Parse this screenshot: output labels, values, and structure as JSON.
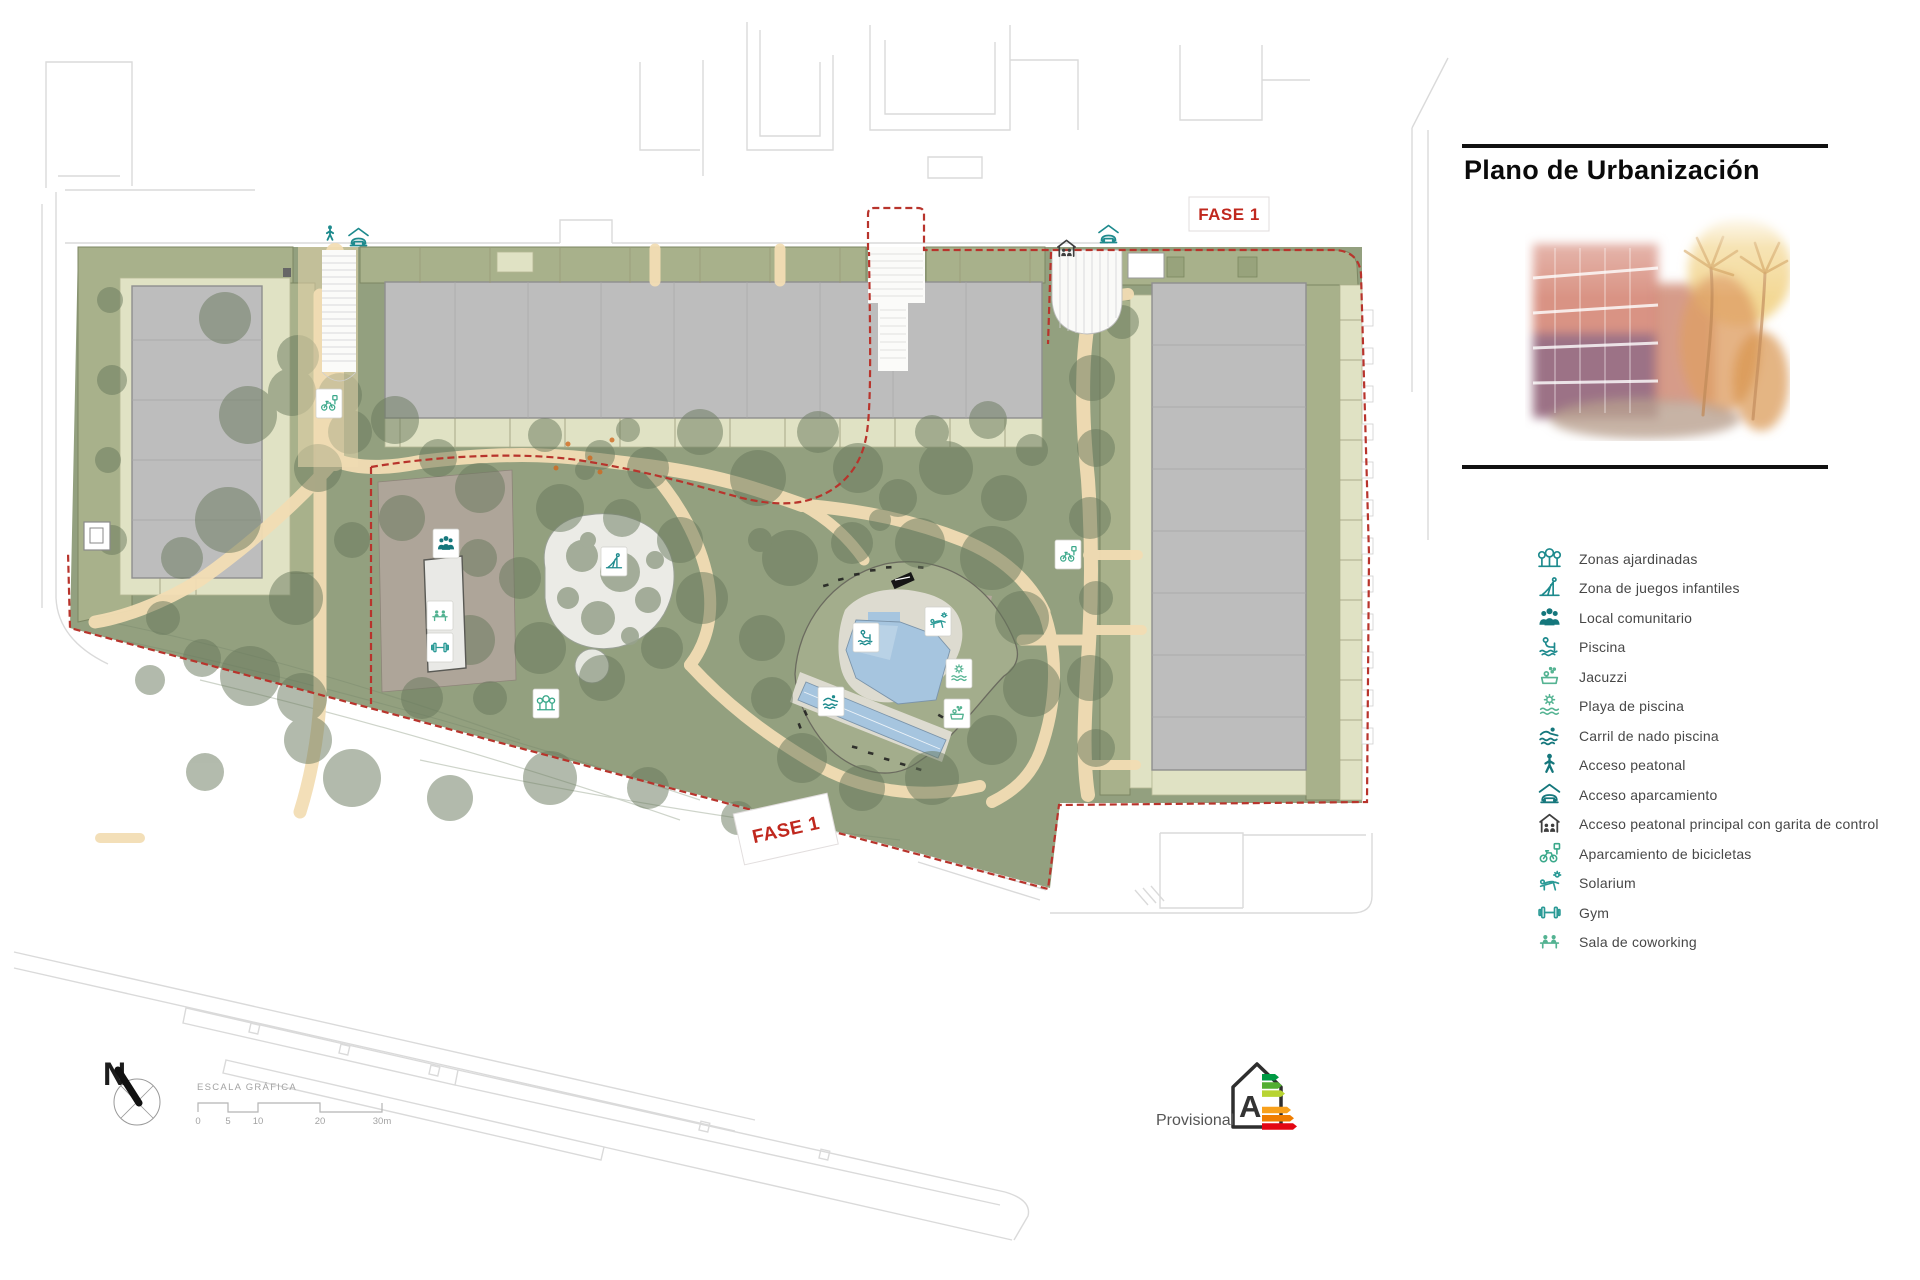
{
  "title": "Plano de Urbanización",
  "map": {
    "fase1_top": "FASE 1",
    "fase1_bottom": "FASE 1"
  },
  "legend": {
    "items": [
      {
        "icon": "trees-icon",
        "label": "Zonas ajardinadas"
      },
      {
        "icon": "playground-icon",
        "label": "Zona de juegos infantiles"
      },
      {
        "icon": "community-icon",
        "label": "Local comunitario"
      },
      {
        "icon": "pool-icon",
        "label": "Piscina"
      },
      {
        "icon": "jacuzzi-icon",
        "label": "Jacuzzi"
      },
      {
        "icon": "pool-beach-icon",
        "label": "Playa de piscina"
      },
      {
        "icon": "swim-lane-icon",
        "label": "Carril de nado piscina"
      },
      {
        "icon": "pedestrian-icon",
        "label": "Acceso peatonal"
      },
      {
        "icon": "parking-access-icon",
        "label": "Acceso aparcamiento"
      },
      {
        "icon": "guardhouse-icon",
        "label": "Acceso peatonal principal con garita de control"
      },
      {
        "icon": "bike-parking-icon",
        "label": "Aparcamiento de bicicletas"
      },
      {
        "icon": "solarium-icon",
        "label": "Solarium"
      },
      {
        "icon": "gym-icon",
        "label": "Gym"
      },
      {
        "icon": "coworking-icon",
        "label": "Sala de coworking"
      }
    ]
  },
  "north": {
    "label": "N"
  },
  "scale": {
    "label": "ESCALA GRÁFICA",
    "ticks": [
      "0",
      "5",
      "10",
      "20",
      "30m"
    ]
  },
  "energy": {
    "text": "Provisional",
    "rating": "A",
    "colors": [
      "#009a44",
      "#52ae32",
      "#b8d433",
      "#ffd500",
      "#f8a01b",
      "#ef7d00",
      "#e30613"
    ]
  },
  "colors": {
    "icon_teal": "#1d8a8d",
    "icon_green": "#54b392",
    "fase_red": "#c0281e",
    "boundary_red": "#b8342c",
    "band_olive": "#a8b18b",
    "garden_green": "#93a07f",
    "path_beige": "#f2ddb4",
    "building_gray": "#bdbdbd",
    "strip_pale": "#e0e2c4",
    "pool_blue": "#a6c5df"
  }
}
